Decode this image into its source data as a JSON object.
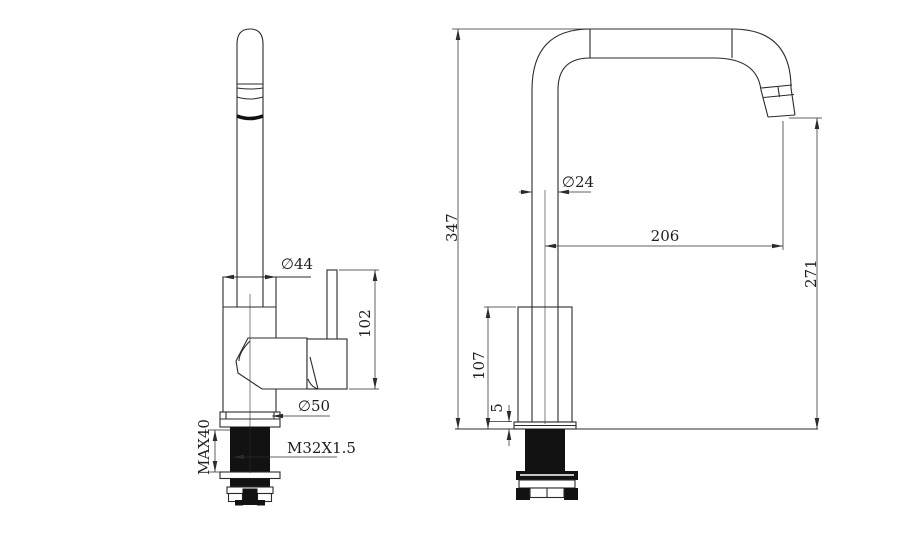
{
  "drawing": {
    "background": "#ffffff",
    "line_color": "#2b2b2b",
    "fill_dark": "#121212",
    "front_view": {
      "name": "faucet-front-view",
      "dimensions": {
        "body_diameter": "∅44",
        "handle_height": "102",
        "base_diameter": "∅50",
        "max_mounting_thickness": "MAX40",
        "thread_spec": "M32X1.5"
      }
    },
    "side_view": {
      "name": "faucet-side-view",
      "dimensions": {
        "overall_height": "347",
        "spout_tube_diameter": "∅24",
        "spout_reach": "206",
        "spout_outlet_height": "271",
        "body_height": "107",
        "base_plate_thickness": "5"
      }
    }
  }
}
